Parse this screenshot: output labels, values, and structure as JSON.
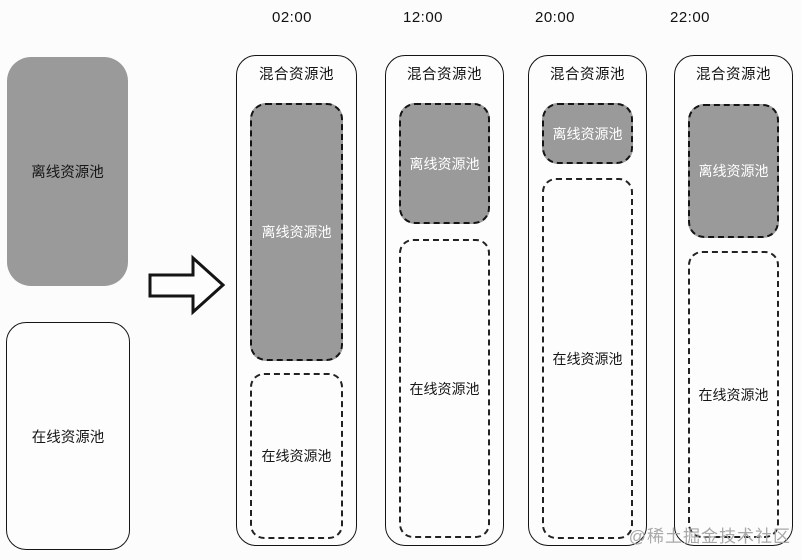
{
  "colors": {
    "pool_fill": "#9a9a9a",
    "line": "#141414",
    "watermark": "#a8a8a8",
    "background": "#fcfcfc"
  },
  "source_pools": {
    "offline_label": "离线资源池",
    "online_label": "在线资源池"
  },
  "watermark_text": "@稀土掘金技术社区",
  "columns": [
    {
      "time": "02:00",
      "title": "混合资源池",
      "offline": {
        "label": "离线资源池",
        "top": 47,
        "height": 258
      },
      "online": {
        "label": "在线资源池",
        "top": 317,
        "height": 166
      }
    },
    {
      "time": "12:00",
      "title": "混合资源池",
      "offline": {
        "label": "离线资源池",
        "top": 47,
        "height": 121
      },
      "online": {
        "label": "在线资源池",
        "top": 183,
        "height": 299
      }
    },
    {
      "time": "20:00",
      "title": "混合资源池",
      "offline": {
        "label": "离线资源池",
        "top": 47,
        "height": 61
      },
      "online": {
        "label": "在线资源池",
        "top": 122,
        "height": 361
      }
    },
    {
      "time": "22:00",
      "title": "混合资源池",
      "offline": {
        "label": "离线资源池",
        "top": 48,
        "height": 134
      },
      "online": {
        "label": "在线资源池",
        "top": 195,
        "height": 287
      }
    }
  ],
  "geometry": {
    "column_lefts": [
      236,
      385,
      528,
      674
    ],
    "column_widths": [
      121,
      119,
      119,
      119
    ],
    "time_label_centers": [
      292,
      423,
      555,
      690
    ]
  }
}
